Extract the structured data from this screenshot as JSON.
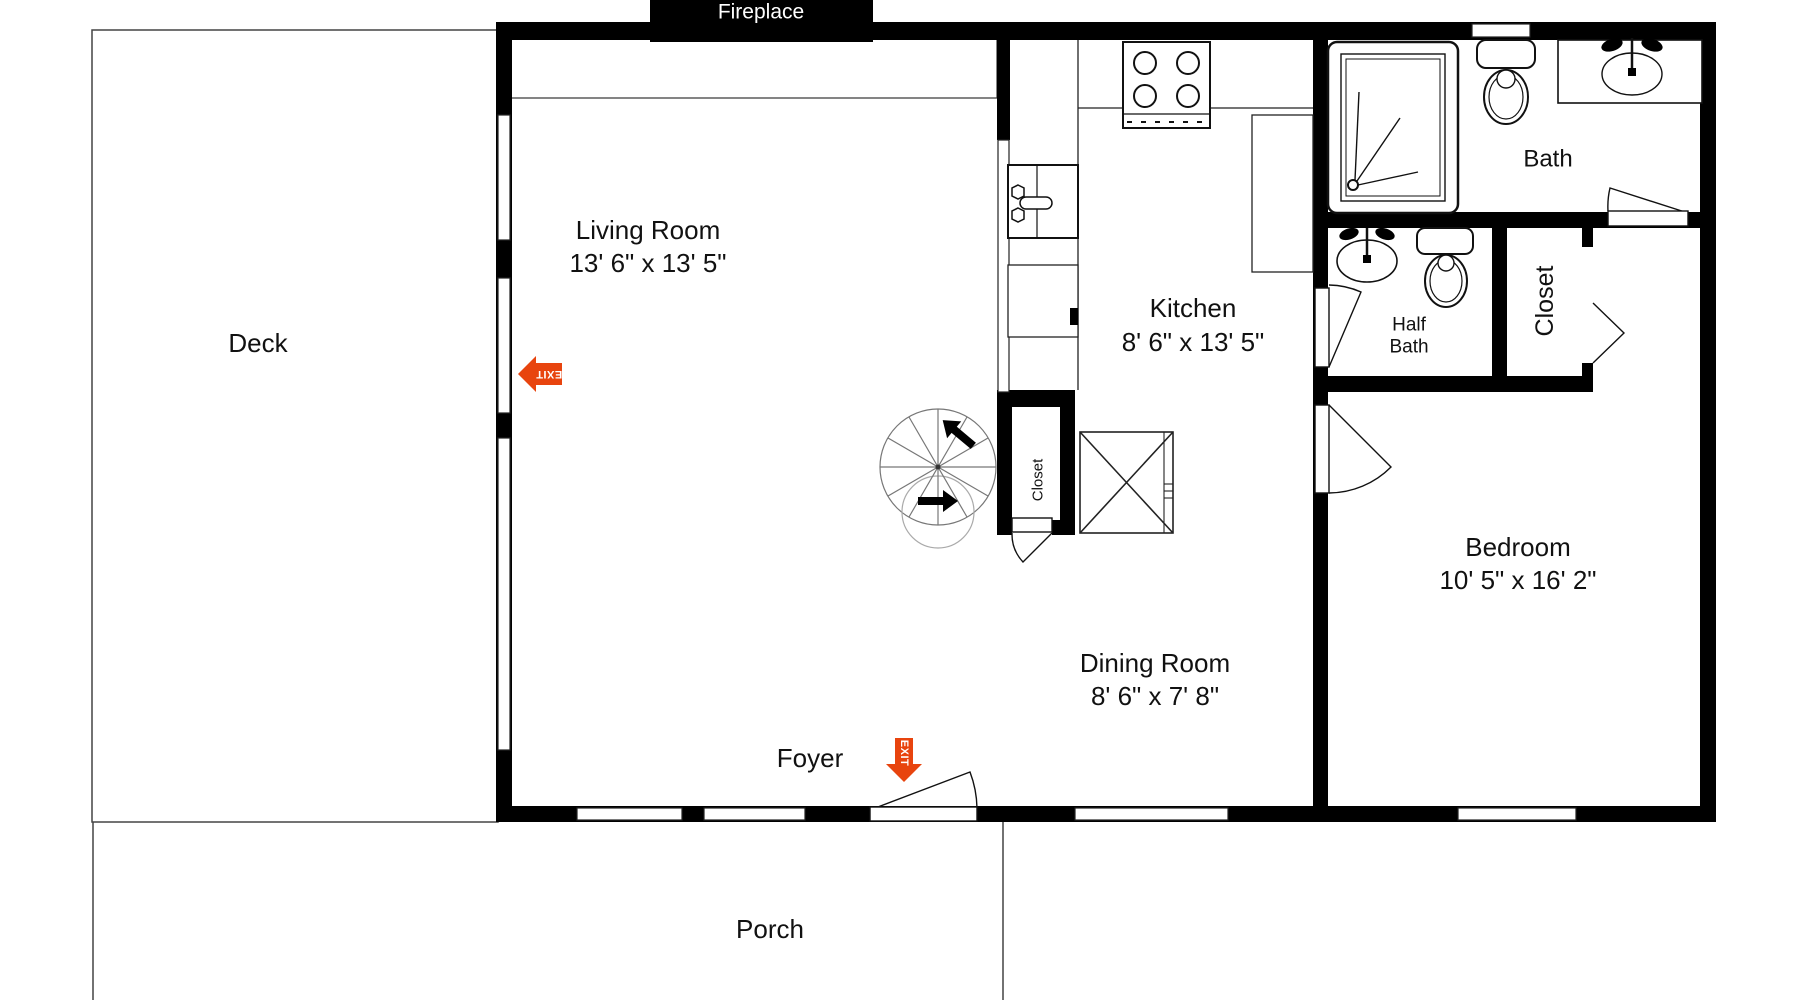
{
  "colors": {
    "wall": "#000000",
    "thin_line": "#222222",
    "exit_sign": "#E8440E",
    "stair_line": "#777777"
  },
  "labels": {
    "fireplace": "Fireplace",
    "deck": "Deck",
    "porch": "Porch",
    "foyer": "Foyer",
    "bath": "Bath",
    "half_bath_line1": "Half",
    "half_bath_line2": "Bath",
    "closet_hall": "Closet",
    "closet_stairs": "Closet",
    "exit": "EXIT",
    "living": {
      "name": "Living Room",
      "dims": "13' 6\" x 13' 5\""
    },
    "kitchen": {
      "name": "Kitchen",
      "dims": "8' 6\" x 13' 5\""
    },
    "dining": {
      "name": "Dining Room",
      "dims": "8' 6\" x 7' 8\""
    },
    "bedroom": {
      "name": "Bedroom",
      "dims": "10' 5\" x 16' 2\""
    }
  }
}
